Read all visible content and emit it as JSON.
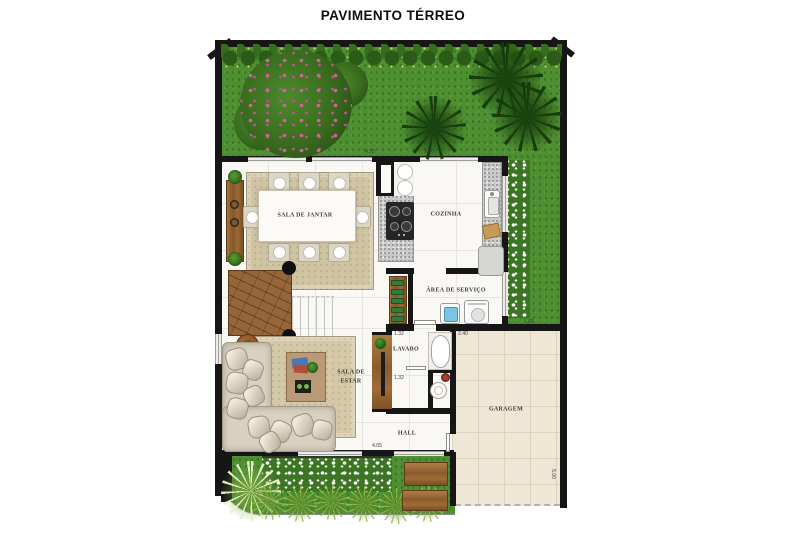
{
  "title": "PAVIMENTO TÉRREO",
  "rooms": [
    {
      "id": "sala-de-jantar",
      "label": "SALA DE JANTAR",
      "x": 305,
      "y": 216,
      "w": 92
    },
    {
      "id": "cozinha",
      "label": "COZINHA",
      "x": 446,
      "y": 215,
      "w": 60
    },
    {
      "id": "area-de-servico",
      "label": "ÁREA DE SERVIÇO",
      "x": 456,
      "y": 291,
      "w": 86
    },
    {
      "id": "lavabo",
      "label": "LAVABO",
      "x": 406,
      "y": 350,
      "w": 42
    },
    {
      "id": "sala-de-estar",
      "label": "SALA DE ESTAR",
      "x": 351,
      "y": 377,
      "w": 28
    },
    {
      "id": "hall",
      "label": "HALL",
      "x": 407,
      "y": 434,
      "w": 40
    },
    {
      "id": "garagem",
      "label": "GARAGEM",
      "x": 506,
      "y": 410,
      "w": 60
    }
  ],
  "dimensions": [
    {
      "label": "4.25",
      "x": 370,
      "y": 152,
      "rot": 0
    },
    {
      "label": "3.00",
      "x": 429,
      "y": 152,
      "rot": 0
    },
    {
      "label": "1.32",
      "x": 399,
      "y": 334,
      "rot": 0
    },
    {
      "label": "2.40",
      "x": 463,
      "y": 334,
      "rot": 0
    },
    {
      "label": "1.65",
      "x": 529,
      "y": 322,
      "rot": 0
    },
    {
      "label": "1.32",
      "x": 399,
      "y": 378,
      "rot": 0
    },
    {
      "label": "4.05",
      "x": 377,
      "y": 446,
      "rot": 0
    },
    {
      "label": "5.00",
      "x": 553,
      "y": 474,
      "rot": 90
    }
  ],
  "colors": {
    "grass": "#4e8f31",
    "wall": "#161616",
    "interior_floor": "#f9f8f4",
    "garage_floor": "#efe7d6",
    "rug": "#cfc3a1",
    "wood": "#9a6a38",
    "water": "#7cc4e4",
    "flower_pink": "#d5619f",
    "title_text": "#0e0e0e"
  }
}
